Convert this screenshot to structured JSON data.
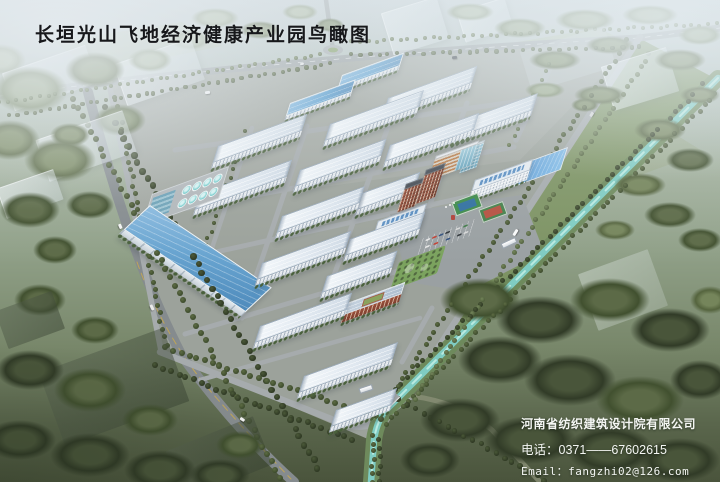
{
  "title": {
    "text": "长垣光山飞地经济健康产业园鸟瞰图"
  },
  "credits": {
    "company": "河南省纺织建筑设计院有限公司",
    "phone_label": "电话：",
    "phone": "0371——67602615",
    "email_label": "Email：",
    "email": "fangzhi02@126.com"
  },
  "scene": {
    "palette": {
      "title_color": "#17181b",
      "credit_color": "#f4f6f3",
      "factory_roof": "#e6edf4",
      "warehouse_roof": "#5fa0ce",
      "canal_water": "#7fccc2",
      "road": "#a6abad",
      "brick": "#9a4f3a",
      "tree": {
        "d": [
          "#49553a",
          "#313b27"
        ],
        "m": [
          "#5c6a47",
          "#41502f"
        ],
        "o": [
          "#75855b",
          "#55643e"
        ],
        "l": [
          "#92a17e",
          "#6e7e58"
        ],
        "h": [
          "#a9b69a",
          "#8a987a"
        ]
      },
      "dot": {
        "d": [
          "#4a5838",
          "#2d3722"
        ],
        "m": [
          "#5d6c44",
          "#3b492b"
        ],
        "o": [
          "#73845a",
          "#4d5d39"
        ]
      }
    },
    "ground": [
      {
        "t": "p",
        "d": "M426,58 L598,28 L656,56 L500,100 Z",
        "f": "rgba(172,186,148,0.5)"
      },
      {
        "t": "p",
        "d": "M55,42 L182,22 L222,46 L95,72 Z",
        "f": "rgba(178,190,158,0.45)"
      },
      {
        "t": "p",
        "d": "M560,132 L642,114 L704,152 L604,188 Z",
        "f": "rgba(148,163,122,0.4)"
      },
      {
        "t": "p",
        "d": "M440,120 L560,98 L600,124 L470,152 Z",
        "f": "rgba(160,175,135,0.35)"
      },
      {
        "t": "p",
        "d": "M639,38 L718,80 L382,410 L405,398 Z",
        "f": "#7d9363"
      },
      {
        "t": "p",
        "d": "M110,86 Q300,55 639,38 L405,398 L375,442 L162,352 Z",
        "f": "#9ca29b"
      },
      {
        "t": "p",
        "d": "M110,86 Q300,55 639,38 L520,160 L140,212 Z",
        "f": "rgba(255,255,255,0.07)"
      },
      {
        "t": "p",
        "d": "M0,96 Q280,58 639,38 L720,28",
        "s": "#9ba1a3",
        "w": 7
      },
      {
        "t": "p",
        "d": "M0,96 Q280,58 639,38 L720,28",
        "s": "rgba(255,255,255,0.7)",
        "w": 0.7,
        "da": "5 7"
      },
      {
        "t": "p",
        "d": "M333,50 L326,0",
        "s": "#9ba1a3",
        "w": 4.5
      },
      {
        "t": "p",
        "d": "M88,92 Q128,252 182,356 Q238,432 294,482",
        "s": "#858b8e",
        "w": 10
      },
      {
        "t": "p",
        "d": "M137,262 Q162,332 206,386 Q246,432 291,479",
        "s": "#c9a94e",
        "w": 1,
        "da": "7 5",
        "o": 0.85
      },
      {
        "t": "p",
        "d": "M110,88 L161,351",
        "s": "#a6abad",
        "w": 5.5
      },
      {
        "t": "p",
        "d": "M160,352 L344,424 Q366,431 380,419 L411,396",
        "s": "#a6abad",
        "w": 6.5
      },
      {
        "t": "p",
        "d": "M411,396 Q460,402 492,430 L540,482",
        "s": "#8a9077",
        "w": 5,
        "o": 0.8
      },
      {
        "t": "p",
        "d": "M640,37 L405,399",
        "s": "#a6abad",
        "w": 6.5
      },
      {
        "t": "p",
        "d": "M561,45 L516,140",
        "s": "#a6abad",
        "w": 5.5
      },
      {
        "t": "p",
        "d": "M432,308 L402,362",
        "s": "#a6abad",
        "w": 5
      },
      {
        "t": "p",
        "d": "M175,150 L535,99",
        "s": "#a6abad",
        "w": 5
      },
      {
        "t": "p",
        "d": "M160,213 L514,147",
        "s": "#a6abad",
        "w": 5
      },
      {
        "t": "p",
        "d": "M170,262 L494,191",
        "s": "#a6abad",
        "w": 5
      },
      {
        "t": "p",
        "d": "M185,334 L462,252",
        "s": "#a6abad",
        "w": 5
      },
      {
        "t": "p",
        "d": "M200,380 L420,318",
        "s": "#a6abad",
        "w": 4.5
      },
      {
        "t": "p",
        "d": "M252,128 L212,248",
        "s": "#a6abad",
        "w": 4.5
      },
      {
        "t": "p",
        "d": "M307,126 L242,318",
        "s": "#a6abad",
        "w": 5
      },
      {
        "t": "p",
        "d": "M392,116 L325,300",
        "s": "#a6abad",
        "w": 5
      },
      {
        "t": "p",
        "d": "M467,103 L397,295",
        "s": "#a6abad",
        "w": 5
      },
      {
        "t": "p",
        "d": "M390,214 L522,195 L544,252 L468,292 L408,282 Z",
        "f": "#9aa0a2"
      },
      {
        "t": "p",
        "d": "M718,78 L388,408 Q377,419 374,440 L371,482",
        "s": "#6e8a5c",
        "w": 16
      },
      {
        "t": "p",
        "d": "M718,78 L388,408 Q377,419 374,440 L371,482",
        "s": "#7fccc2",
        "w": 6.5
      },
      {
        "t": "p",
        "d": "M718,78 L388,408 Q377,419 374,440 L371,482",
        "s": "rgba(196,238,230,0.85)",
        "w": 2,
        "da": "12 9"
      },
      {
        "t": "e",
        "cx": 333,
        "cy": 50,
        "rx": 10,
        "ry": 5,
        "f": "#a6abad"
      },
      {
        "t": "e",
        "cx": 333,
        "cy": 50,
        "rx": 5,
        "ry": 2.4,
        "f": "#7f9a5e"
      }
    ],
    "trees": [
      [
        30,
        90,
        38,
        24,
        "l"
      ],
      [
        95,
        70,
        30,
        18,
        "o"
      ],
      [
        10,
        140,
        30,
        20,
        "o"
      ],
      [
        60,
        160,
        36,
        22,
        "o"
      ],
      [
        120,
        120,
        26,
        16,
        "o"
      ],
      [
        30,
        210,
        30,
        18,
        "m"
      ],
      [
        90,
        205,
        24,
        14,
        "m"
      ],
      [
        0,
        60,
        26,
        16,
        "h"
      ],
      [
        150,
        60,
        22,
        12,
        "h"
      ],
      [
        190,
        40,
        20,
        10,
        "h"
      ],
      [
        215,
        18,
        24,
        10,
        "h"
      ],
      [
        260,
        30,
        20,
        9,
        "o"
      ],
      [
        300,
        12,
        18,
        8,
        "h"
      ],
      [
        330,
        25,
        14,
        7,
        "o"
      ],
      [
        470,
        12,
        24,
        9,
        "h"
      ],
      [
        520,
        28,
        26,
        10,
        "l"
      ],
      [
        585,
        20,
        30,
        11,
        "l"
      ],
      [
        650,
        15,
        28,
        10,
        "l"
      ],
      [
        700,
        35,
        22,
        10,
        "l"
      ],
      [
        555,
        60,
        26,
        10,
        "o"
      ],
      [
        610,
        45,
        24,
        9,
        "o"
      ],
      [
        680,
        60,
        26,
        11,
        "o"
      ],
      [
        700,
        95,
        20,
        9,
        "o"
      ],
      [
        600,
        95,
        26,
        10,
        "o"
      ],
      [
        545,
        90,
        20,
        8,
        "l"
      ],
      [
        660,
        130,
        26,
        12,
        "o"
      ],
      [
        690,
        160,
        24,
        12,
        "m"
      ],
      [
        640,
        185,
        26,
        12,
        "o"
      ],
      [
        670,
        215,
        26,
        13,
        "m"
      ],
      [
        700,
        240,
        22,
        12,
        "m"
      ],
      [
        615,
        230,
        20,
        10,
        "o"
      ],
      [
        585,
        105,
        14,
        7,
        "o"
      ],
      [
        480,
        300,
        40,
        22,
        "m"
      ],
      [
        540,
        320,
        44,
        24,
        "d"
      ],
      [
        610,
        300,
        40,
        22,
        "m"
      ],
      [
        670,
        330,
        40,
        22,
        "d"
      ],
      [
        500,
        360,
        42,
        24,
        "d"
      ],
      [
        570,
        380,
        46,
        26,
        "d"
      ],
      [
        640,
        400,
        44,
        24,
        "m"
      ],
      [
        700,
        380,
        30,
        20,
        "d"
      ],
      [
        460,
        420,
        40,
        22,
        "d"
      ],
      [
        530,
        440,
        46,
        24,
        "d"
      ],
      [
        610,
        450,
        44,
        24,
        "d"
      ],
      [
        680,
        460,
        40,
        22,
        "d"
      ],
      [
        430,
        460,
        30,
        18,
        "d"
      ],
      [
        710,
        300,
        20,
        14,
        "o"
      ],
      [
        30,
        370,
        34,
        20,
        "d"
      ],
      [
        90,
        390,
        36,
        22,
        "m"
      ],
      [
        20,
        440,
        36,
        20,
        "d"
      ],
      [
        90,
        455,
        40,
        22,
        "d"
      ],
      [
        160,
        470,
        36,
        20,
        "d"
      ],
      [
        220,
        475,
        30,
        16,
        "d"
      ],
      [
        150,
        420,
        28,
        16,
        "m"
      ],
      [
        240,
        445,
        24,
        14,
        "m"
      ],
      [
        55,
        250,
        22,
        14,
        "m"
      ],
      [
        40,
        300,
        26,
        16,
        "m"
      ],
      [
        95,
        330,
        24,
        14,
        "m"
      ],
      [
        70,
        135,
        20,
        12,
        "o"
      ]
    ],
    "treelines": [
      [
        0,
        103,
        320,
        55,
        2,
        "o",
        8
      ],
      [
        352,
        42,
        716,
        24,
        2,
        "o",
        8
      ],
      [
        10,
        116,
        330,
        64,
        2.2,
        "m",
        8
      ],
      [
        352,
        55,
        640,
        47,
        2.2,
        "m",
        9
      ],
      [
        74,
        100,
        280,
        478,
        3,
        "m",
        9
      ],
      [
        106,
        108,
        318,
        468,
        3.2,
        "d",
        9
      ],
      [
        116,
        98,
        166,
        345,
        2.5,
        "m",
        8
      ],
      [
        166,
        348,
        382,
        418,
        3,
        "m",
        8
      ],
      [
        156,
        366,
        352,
        440,
        3,
        "d",
        8
      ],
      [
        628,
        40,
        398,
        386,
        2.5,
        "m",
        8
      ],
      [
        650,
        54,
        414,
        400,
        2.5,
        "o",
        8
      ],
      [
        704,
        84,
        378,
        406,
        2.5,
        "d",
        8
      ],
      [
        716,
        94,
        386,
        424,
        2.5,
        "m",
        8
      ],
      [
        553,
        55,
        510,
        145,
        2,
        "o",
        9
      ],
      [
        374,
        436,
        372,
        482,
        2.5,
        "m",
        7
      ],
      [
        380,
        440,
        379,
        482,
        2.5,
        "d",
        8
      ],
      [
        399,
        400,
        545,
        480,
        2.8,
        "d",
        9
      ],
      [
        246,
        132,
        206,
        246,
        2,
        "m",
        8
      ]
    ],
    "ghosts": [
      [
        6,
        58,
        88,
        40,
        -19,
        "l"
      ],
      [
        118,
        50,
        82,
        44,
        -19,
        "l"
      ],
      [
        40,
        124,
        92,
        44,
        -19,
        "l"
      ],
      [
        0,
        178,
        60,
        32,
        -19,
        "l"
      ],
      [
        386,
        4,
        58,
        44,
        -17,
        "l"
      ],
      [
        460,
        4,
        50,
        32,
        -17,
        "l"
      ],
      [
        524,
        38,
        88,
        42,
        -17,
        "lp"
      ],
      [
        606,
        56,
        68,
        46,
        -17,
        "l"
      ],
      [
        586,
        260,
        74,
        60,
        -20,
        "lf"
      ],
      [
        48,
        348,
        132,
        78,
        -20,
        "dk"
      ],
      [
        172,
        432,
        94,
        52,
        -22,
        "dk"
      ],
      [
        0,
        300,
        60,
        40,
        -20,
        "dk"
      ]
    ],
    "buildings": [
      {
        "t": "b",
        "n": "blue-shed",
        "x": 342,
        "y": 75,
        "l": 66
      },
      {
        "t": "b",
        "n": "blue-shed",
        "x": 290,
        "y": 103,
        "l": 70
      },
      {
        "t": "wh",
        "n": "blue-warehouse",
        "x": 150,
        "y": 205,
        "l": 145
      },
      {
        "t": "w",
        "n": "factory",
        "x": 330,
        "y": 124,
        "l": 100
      },
      {
        "t": "w",
        "n": "factory",
        "x": 388,
        "y": 98,
        "l": 95
      },
      {
        "t": "w",
        "n": "factory",
        "x": 458,
        "y": 122,
        "l": 85
      },
      {
        "t": "w",
        "n": "factory",
        "x": 218,
        "y": 146,
        "l": 95
      },
      {
        "t": "w",
        "n": "factory",
        "x": 300,
        "y": 170,
        "l": 92
      },
      {
        "t": "w",
        "n": "factory",
        "x": 390,
        "y": 145,
        "l": 95
      },
      {
        "t": "w",
        "n": "factory",
        "x": 200,
        "y": 193,
        "l": 98
      },
      {
        "t": "w",
        "n": "factory",
        "x": 282,
        "y": 216,
        "l": 88
      },
      {
        "t": "w",
        "n": "factory",
        "x": 362,
        "y": 193,
        "l": 62
      },
      {
        "t": "w",
        "n": "factory",
        "x": 262,
        "y": 263,
        "l": 95
      },
      {
        "t": "w",
        "n": "factory",
        "x": 350,
        "y": 239,
        "l": 80
      },
      {
        "t": "w",
        "n": "factory",
        "x": 260,
        "y": 326,
        "l": 98
      },
      {
        "t": "w",
        "n": "factory",
        "x": 327,
        "y": 276,
        "l": 75
      },
      {
        "t": "w",
        "n": "factory",
        "x": 304,
        "y": 376,
        "l": 100
      },
      {
        "t": "w",
        "n": "factory",
        "x": 336,
        "y": 410,
        "l": 65
      },
      {
        "t": "dorm",
        "n": "dormitory",
        "x": 347,
        "y": 303,
        "l": 62
      },
      {
        "t": "al",
        "n": "admin-long-building",
        "x": 475,
        "y": 180,
        "l": 62
      },
      {
        "t": "a4",
        "n": "admin-building",
        "x": 378,
        "y": 221,
        "l": 52
      },
      {
        "t": "rt",
        "n": "brick-tower",
        "x": 426,
        "y": 170,
        "l": 21,
        "hh": {
          "rtwall": 30
        }
      },
      {
        "t": "rt",
        "n": "brick-tower",
        "x": 406,
        "y": 184,
        "l": 19,
        "hh": {
          "rtwall": 24
        }
      },
      {
        "t": "st",
        "n": "striped-office",
        "x": 436,
        "y": 156,
        "l": 46
      },
      {
        "t": "gl",
        "n": "glass-tower",
        "x": 468,
        "y": 146,
        "l": 18
      }
    ],
    "special": [
      {
        "t": "wwtp",
        "n": "water-treatment",
        "x": 152,
        "y": 194,
        "w": 80,
        "h": 32
      },
      {
        "t": "pond",
        "n": "pond",
        "x": 521,
        "y": 164,
        "w": 48,
        "h": 22
      },
      {
        "t": "court1",
        "n": "basketball-court",
        "x": 453,
        "y": 197,
        "w": 26,
        "h": 13,
        "rot": -20
      },
      {
        "t": "court2",
        "n": "tennis-court",
        "x": 480,
        "y": 205,
        "w": 24,
        "h": 12,
        "rot": -20
      },
      {
        "t": "parking",
        "n": "parking-lot",
        "x": 423,
        "y": 238,
        "w": 55,
        "h": 18
      },
      {
        "t": "garden",
        "n": "central-garden",
        "x": 399,
        "y": 262,
        "w": 50,
        "h": 30
      },
      {
        "t": "gate",
        "n": "east-gate",
        "x": 501,
        "y": 240,
        "w": 14,
        "h": 4,
        "rot": -25
      },
      {
        "t": "gate",
        "n": "south-gate",
        "x": 359,
        "y": 386,
        "w": 12,
        "h": 4,
        "rot": -18
      },
      {
        "t": "bridge",
        "n": "canal-bridge",
        "x": 384,
        "y": 395,
        "w": 15,
        "h": 7,
        "rot": -44
      }
    ],
    "cars": [
      [
        205,
        91,
        -7,
        "#f4f4f4",
        5,
        2.5
      ],
      [
        452,
        56,
        -7,
        "#343840",
        5,
        2.5
      ],
      [
        300,
        63,
        -7,
        "#e9e9e9",
        4,
        2
      ],
      [
        118,
        225,
        66,
        "#f4f4f4",
        5,
        2.5
      ],
      [
        149,
        306,
        64,
        "#e9e9e9",
        6,
        3
      ],
      [
        512,
        231,
        -58,
        "#fafafa",
        7,
        3
      ],
      [
        589,
        113,
        -58,
        "#d9d9d9",
        5,
        2.5
      ],
      [
        240,
        418,
        35,
        "#f0f0f0",
        5,
        2.5
      ]
    ],
    "decos": [
      [
        451,
        215,
        4,
        5,
        0,
        "#b04038"
      ],
      [
        445,
        206,
        2,
        2,
        0,
        "#f2f2f2"
      ],
      [
        449,
        204,
        2,
        2,
        0,
        "#f2f2f2"
      ],
      [
        453,
        202,
        2,
        2,
        0,
        "#f2f2f2"
      ]
    ],
    "parking_cars": {
      "offsets": [
        [
          4,
          3
        ],
        [
          11,
          3
        ],
        [
          18,
          3
        ],
        [
          25,
          3
        ],
        [
          36,
          3
        ],
        [
          44,
          3
        ],
        [
          6,
          11
        ],
        [
          15,
          11
        ],
        [
          28,
          11
        ],
        [
          40,
          11
        ],
        [
          47,
          11
        ]
      ],
      "colors": [
        "#e8e8e8",
        "#c33f32",
        "#32507e",
        "#2e3338",
        "#d8d8d8",
        "#3f7a46"
      ]
    }
  }
}
